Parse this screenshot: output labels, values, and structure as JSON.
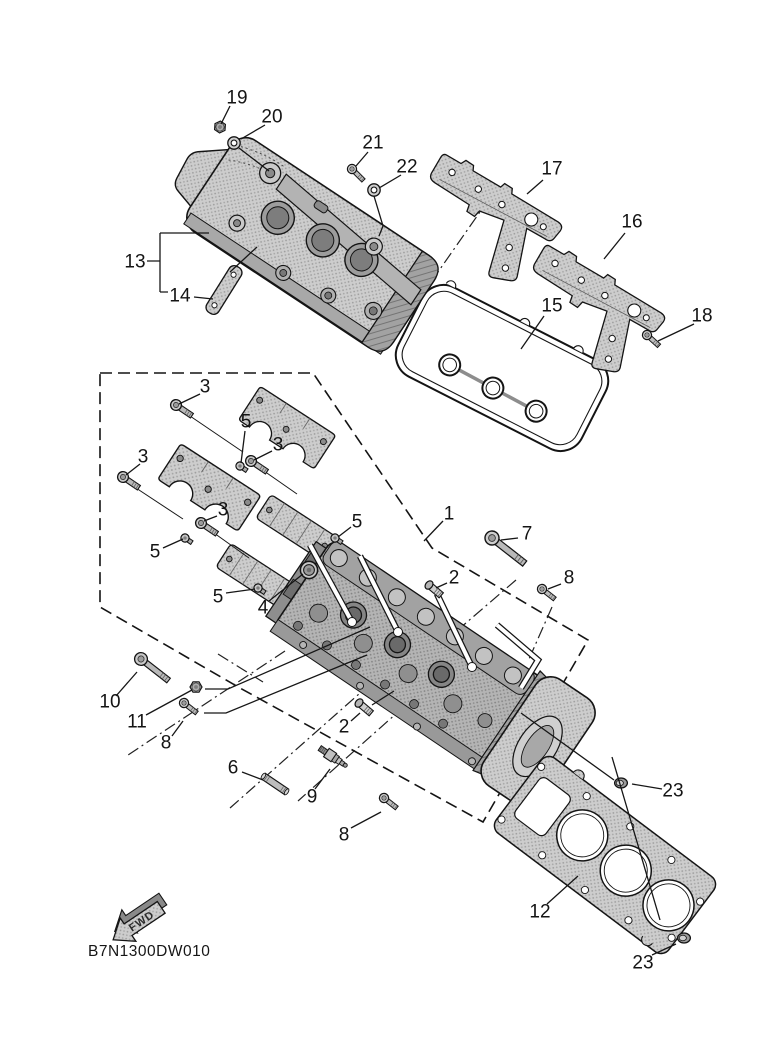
{
  "diagram": {
    "code": "B7N1300DW010",
    "fwd": "FWD"
  },
  "callouts": [
    {
      "label": "19",
      "x": 237,
      "y": 98
    },
    {
      "label": "20",
      "x": 272,
      "y": 117
    },
    {
      "label": "21",
      "x": 373,
      "y": 143
    },
    {
      "label": "22",
      "x": 407,
      "y": 167
    },
    {
      "label": "17",
      "x": 552,
      "y": 169
    },
    {
      "label": "16",
      "x": 632,
      "y": 222
    },
    {
      "label": "18",
      "x": 702,
      "y": 316
    },
    {
      "label": "15",
      "x": 552,
      "y": 306
    },
    {
      "label": "13",
      "x": 135,
      "y": 262
    },
    {
      "label": "14",
      "x": 180,
      "y": 296
    },
    {
      "label": "3",
      "x": 205,
      "y": 387
    },
    {
      "label": "3",
      "x": 143,
      "y": 457
    },
    {
      "label": "3",
      "x": 278,
      "y": 445
    },
    {
      "label": "3",
      "x": 223,
      "y": 510
    },
    {
      "label": "5",
      "x": 246,
      "y": 422
    },
    {
      "label": "5",
      "x": 357,
      "y": 522
    },
    {
      "label": "5",
      "x": 155,
      "y": 552
    },
    {
      "label": "5",
      "x": 218,
      "y": 597
    },
    {
      "label": "4",
      "x": 263,
      "y": 608
    },
    {
      "label": "1",
      "x": 449,
      "y": 514
    },
    {
      "label": "7",
      "x": 527,
      "y": 534
    },
    {
      "label": "2",
      "x": 454,
      "y": 578
    },
    {
      "label": "8",
      "x": 569,
      "y": 578
    },
    {
      "label": "2",
      "x": 344,
      "y": 727
    },
    {
      "label": "6",
      "x": 233,
      "y": 768
    },
    {
      "label": "9",
      "x": 312,
      "y": 797
    },
    {
      "label": "8",
      "x": 344,
      "y": 835
    },
    {
      "label": "8",
      "x": 166,
      "y": 743
    },
    {
      "label": "10",
      "x": 110,
      "y": 702
    },
    {
      "label": "11",
      "x": 137,
      "y": 722
    },
    {
      "label": "12",
      "x": 540,
      "y": 912
    },
    {
      "label": "23",
      "x": 673,
      "y": 791
    },
    {
      "label": "23",
      "x": 643,
      "y": 963
    }
  ]
}
